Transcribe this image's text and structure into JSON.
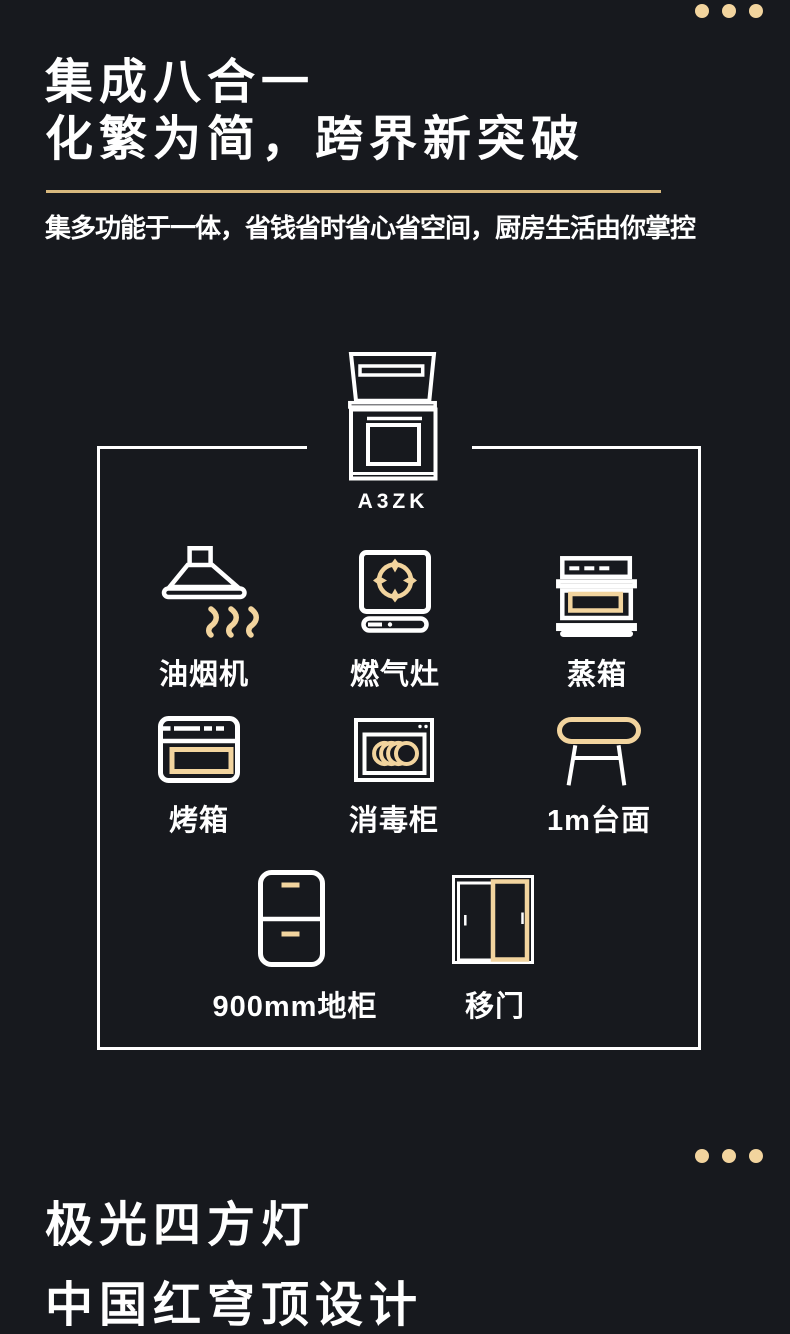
{
  "theme": {
    "background": "#17191e",
    "foreground": "#ffffff",
    "gold": "#f2d49e",
    "gold_line": "#d8b97e"
  },
  "decor": {
    "dots_count": 3
  },
  "section1": {
    "title_line1": "集成八合一",
    "title_line2": "化繁为简，跨界新突破",
    "subtitle": "集多功能于一体，省钱省时省心省空间，厨房生活由你掌控",
    "model": "A3ZK",
    "items": [
      {
        "label": "油烟机",
        "icon": "range-hood-icon"
      },
      {
        "label": "燃气灶",
        "icon": "gas-stove-icon"
      },
      {
        "label": "蒸箱",
        "icon": "steam-oven-icon"
      },
      {
        "label": "烤箱",
        "icon": "oven-icon"
      },
      {
        "label": "消毒柜",
        "icon": "disinfection-cabinet-icon"
      },
      {
        "label": "1m台面",
        "icon": "countertop-icon"
      },
      {
        "label": "900mm地柜",
        "icon": "base-cabinet-icon"
      },
      {
        "label": "移门",
        "icon": "sliding-door-icon"
      }
    ]
  },
  "section2": {
    "title_line1": "极光四方灯",
    "title_line2": "中国红穹顶设计"
  }
}
